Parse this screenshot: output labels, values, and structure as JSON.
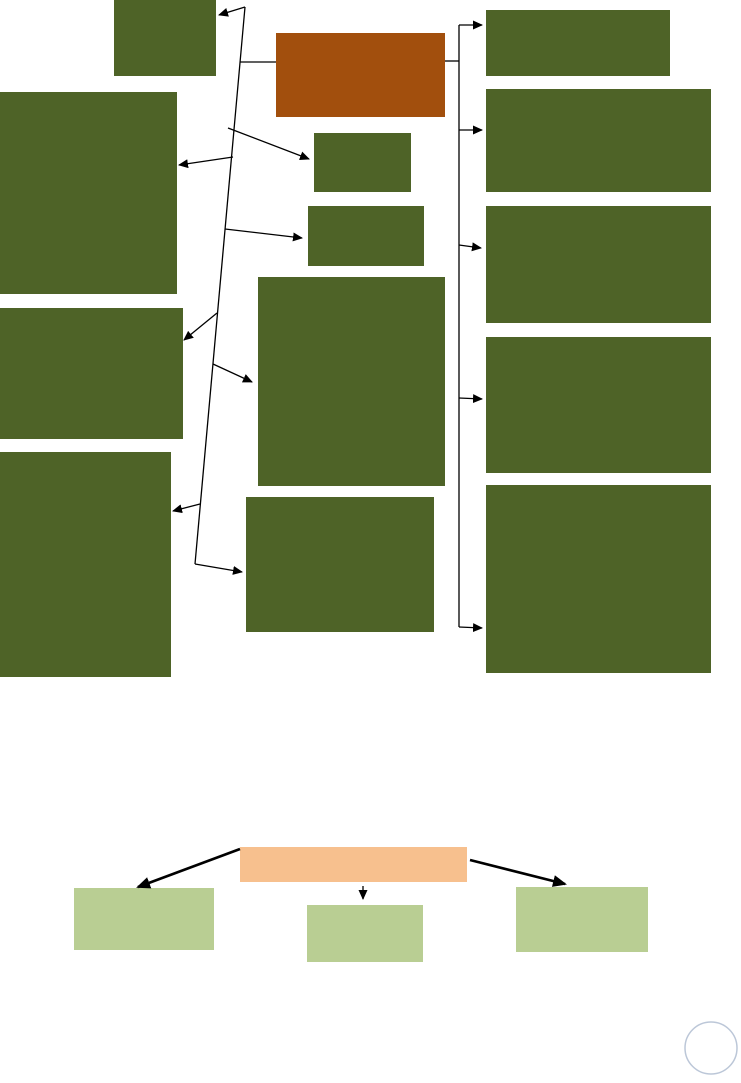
{
  "page": {
    "background": "#ffffff"
  },
  "palette": {
    "dark_green": "#4E6327",
    "brown": "#A24F0D",
    "peach": "#F7C08E",
    "light_green": "#B9CE93",
    "connector": "#000000",
    "circle_stroke": "#BCC7D8"
  },
  "diagram": {
    "nodes": [
      {
        "id": "top-center-box",
        "x": 114,
        "y": 0,
        "w": 102,
        "h": 76,
        "color": "dark_green",
        "label": ""
      },
      {
        "id": "brown-box",
        "x": 276,
        "y": 33,
        "w": 169,
        "h": 84,
        "color": "brown",
        "label": ""
      },
      {
        "id": "left-box-1",
        "x": 0,
        "y": 92,
        "w": 177,
        "h": 202,
        "color": "dark_green",
        "label": ""
      },
      {
        "id": "mid-small-box-1",
        "x": 314,
        "y": 133,
        "w": 97,
        "h": 59,
        "color": "dark_green",
        "label": ""
      },
      {
        "id": "mid-small-box-2",
        "x": 308,
        "y": 206,
        "w": 116,
        "h": 60,
        "color": "dark_green",
        "label": ""
      },
      {
        "id": "mid-large-box",
        "x": 258,
        "y": 277,
        "w": 187,
        "h": 209,
        "color": "dark_green",
        "label": ""
      },
      {
        "id": "left-box-2",
        "x": 0,
        "y": 308,
        "w": 183,
        "h": 131,
        "color": "dark_green",
        "label": ""
      },
      {
        "id": "left-box-3",
        "x": 0,
        "y": 452,
        "w": 171,
        "h": 225,
        "color": "dark_green",
        "label": ""
      },
      {
        "id": "mid-bottom-box",
        "x": 246,
        "y": 497,
        "w": 188,
        "h": 135,
        "color": "dark_green",
        "label": ""
      },
      {
        "id": "right-box-1",
        "x": 486,
        "y": 10,
        "w": 184,
        "h": 66,
        "color": "dark_green",
        "label": ""
      },
      {
        "id": "right-box-2",
        "x": 486,
        "y": 89,
        "w": 225,
        "h": 103,
        "color": "dark_green",
        "label": ""
      },
      {
        "id": "right-box-3",
        "x": 486,
        "y": 206,
        "w": 225,
        "h": 117,
        "color": "dark_green",
        "label": ""
      },
      {
        "id": "right-box-4",
        "x": 486,
        "y": 337,
        "w": 225,
        "h": 136,
        "color": "dark_green",
        "label": ""
      },
      {
        "id": "right-box-5",
        "x": 486,
        "y": 485,
        "w": 225,
        "h": 188,
        "color": "dark_green",
        "label": ""
      },
      {
        "id": "peach-bar",
        "x": 240,
        "y": 847,
        "w": 227,
        "h": 35,
        "color": "peach",
        "label": ""
      },
      {
        "id": "light-green-box-1",
        "x": 74,
        "y": 888,
        "w": 140,
        "h": 62,
        "color": "light_green",
        "label": ""
      },
      {
        "id": "light-green-box-2",
        "x": 307,
        "y": 905,
        "w": 116,
        "h": 57,
        "color": "light_green",
        "label": ""
      },
      {
        "id": "light-green-box-3",
        "x": 516,
        "y": 887,
        "w": 132,
        "h": 65,
        "color": "light_green",
        "label": ""
      }
    ],
    "connectors": [
      {
        "id": "spine-left-slanted-line",
        "points": [
          [
            245,
            7
          ],
          [
            195,
            564
          ]
        ],
        "arrow": false,
        "width": 1.3
      },
      {
        "id": "edge-spine-to-top-center-box",
        "points": [
          [
            245,
            7
          ],
          [
            219,
            15
          ]
        ],
        "arrow": true,
        "width": 1.3
      },
      {
        "id": "connector-spine-to-brown-box-left",
        "points": [
          [
            240,
            62
          ],
          [
            276,
            62
          ]
        ],
        "arrow": false,
        "width": 1.3
      },
      {
        "id": "edge-spine-to-mid-small-box-1",
        "points": [
          [
            228,
            128
          ],
          [
            309,
            159
          ]
        ],
        "arrow": true,
        "width": 1.3
      },
      {
        "id": "edge-spine-to-left-box-1",
        "points": [
          [
            233,
            157
          ],
          [
            179,
            165
          ]
        ],
        "arrow": true,
        "width": 1.3
      },
      {
        "id": "edge-spine-to-mid-small-box-2",
        "points": [
          [
            225,
            229
          ],
          [
            302,
            238
          ]
        ],
        "arrow": true,
        "width": 1.3
      },
      {
        "id": "edge-spine-to-left-box-2",
        "points": [
          [
            217,
            313
          ],
          [
            184,
            340
          ]
        ],
        "arrow": true,
        "width": 1.3
      },
      {
        "id": "edge-spine-to-mid-large-box",
        "points": [
          [
            213,
            364
          ],
          [
            252,
            382
          ]
        ],
        "arrow": true,
        "width": 1.3
      },
      {
        "id": "edge-spine-to-left-box-3",
        "points": [
          [
            200,
            504
          ],
          [
            173,
            511
          ]
        ],
        "arrow": true,
        "width": 1.3
      },
      {
        "id": "edge-spine-to-mid-bottom-box",
        "points": [
          [
            195,
            564
          ],
          [
            242,
            572
          ]
        ],
        "arrow": true,
        "width": 1.3
      },
      {
        "id": "spine-right-vertical-line",
        "points": [
          [
            459,
            25
          ],
          [
            459,
            627
          ]
        ],
        "arrow": false,
        "width": 1.3
      },
      {
        "id": "edge-spine-to-right-box-1",
        "points": [
          [
            459,
            25
          ],
          [
            482,
            25
          ]
        ],
        "arrow": true,
        "width": 1.3
      },
      {
        "id": "connector-brown-box-to-spine-right",
        "points": [
          [
            445,
            61
          ],
          [
            459,
            61
          ]
        ],
        "arrow": false,
        "width": 1.3
      },
      {
        "id": "edge-spine-to-right-box-2",
        "points": [
          [
            459,
            130
          ],
          [
            482,
            130
          ]
        ],
        "arrow": true,
        "width": 1.3
      },
      {
        "id": "edge-spine-to-right-box-3",
        "points": [
          [
            459,
            245
          ],
          [
            481,
            248
          ]
        ],
        "arrow": true,
        "width": 1.3
      },
      {
        "id": "edge-spine-to-right-box-4",
        "points": [
          [
            459,
            398
          ],
          [
            482,
            399
          ]
        ],
        "arrow": true,
        "width": 1.3
      },
      {
        "id": "edge-spine-to-right-box-5",
        "points": [
          [
            459,
            627
          ],
          [
            482,
            628
          ]
        ],
        "arrow": true,
        "width": 1.3
      },
      {
        "id": "edge-peach-to-light-green-box-1",
        "points": [
          [
            240,
            849
          ],
          [
            138,
            887
          ]
        ],
        "arrow": true,
        "width": 2.6
      },
      {
        "id": "edge-peach-to-light-green-box-2",
        "points": [
          [
            363,
            886
          ],
          [
            363,
            899
          ]
        ],
        "arrow": true,
        "width": 1.3
      },
      {
        "id": "edge-peach-to-light-green-box-3",
        "points": [
          [
            470,
            860
          ],
          [
            565,
            884
          ]
        ],
        "arrow": true,
        "width": 2.6
      }
    ],
    "circle": {
      "cx": 711,
      "cy": 1048,
      "r": 26,
      "stroke_width": 1.5
    }
  }
}
